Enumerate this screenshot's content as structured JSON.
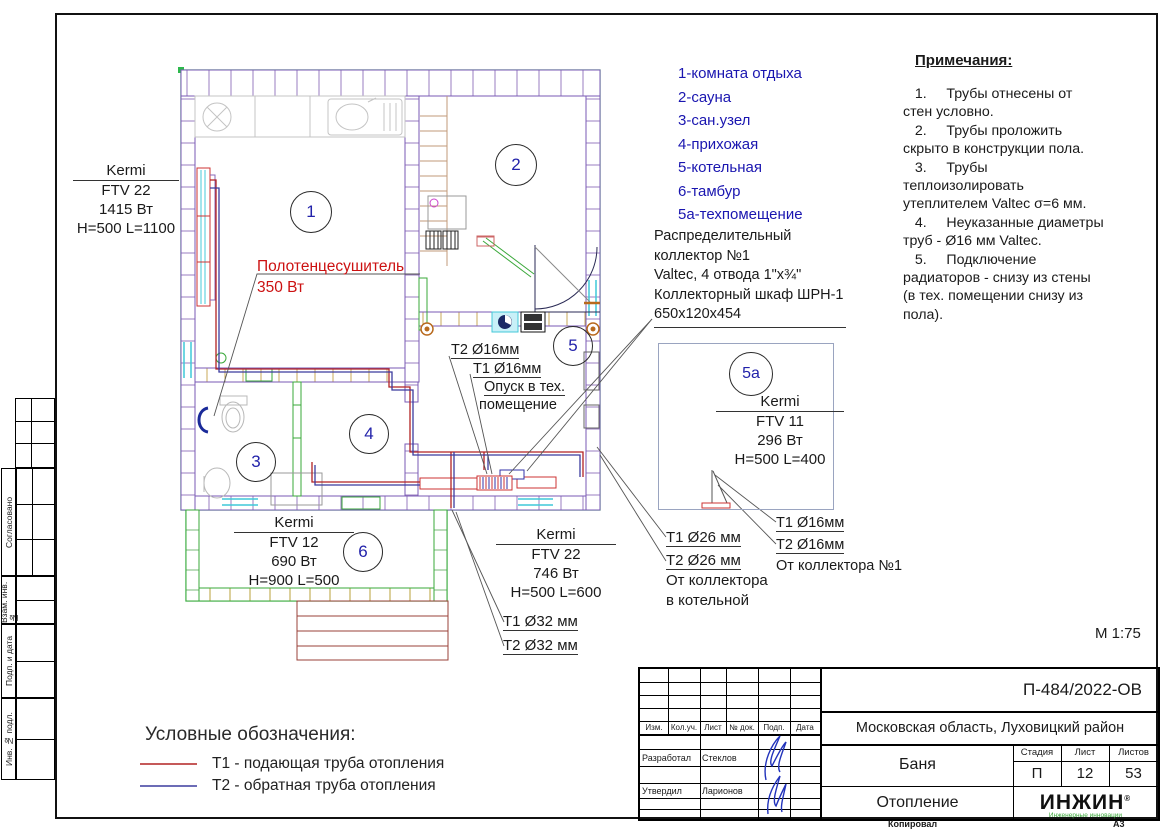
{
  "side_strip": {
    "labels": [
      "Согласовано",
      "Взам. инв. №",
      "Подп. и дата",
      "Инв. № подл."
    ]
  },
  "room_numbers": {
    "r1": "1",
    "r2": "2",
    "r3": "3",
    "r4": "4",
    "r5": "5",
    "r6": "6",
    "r5a": "5а"
  },
  "room_legend": {
    "items": [
      "1-комната отдыха",
      "2-сауна",
      "3-сан.узел",
      "4-прихожая",
      "5-котельная",
      "6-тамбур",
      "5а-техпомещение"
    ]
  },
  "collector_note": {
    "lines": [
      "Распределительный",
      "коллектор №1",
      "Valtec, 4 отвода 1\"х¾\"",
      "Коллекторный шкаф ШРН-1",
      "650х120х454"
    ]
  },
  "notes": {
    "title": "Примечания:",
    "items": [
      "   1.     Трубы отнесены от\nстен условно.",
      "   2.     Трубы проложить\nскрыто в конструкции пола.",
      "   3.     Трубы\nтеплоизолировать\nутеплителем Valtec σ=6 мм.",
      "   4.     Неуказанные диаметры\nтруб - Ø16 мм Valtec.",
      "   5.     Подключение\nрадиаторов - снизу из стены\n(в тех. помещении снизу из\nпола)."
    ]
  },
  "radiators": {
    "room1": {
      "brand": "Kermi",
      "model": "FTV 22",
      "power": "1415 Вт",
      "size": "H=500 L=1100"
    },
    "room6": {
      "brand": "Kermi",
      "model": "FTV 12",
      "power": "690 Вт",
      "size": "H=900 L=500"
    },
    "hall": {
      "brand": "Kermi",
      "model": "FTV 22",
      "power": "746 Вт",
      "size": "H=500 L=600"
    },
    "tech": {
      "brand": "Kermi",
      "model": "FTV 11",
      "power": "296 Вт",
      "size": "H=500 L=400"
    }
  },
  "towel_rail": {
    "name": "Полотенцесушитель",
    "power": "350 Вт"
  },
  "pipe_labels": {
    "drop_t2": "Т2 Ø16мм",
    "drop_t1": "Т1 Ø16мм",
    "drop_text1": "Опуск в тех.",
    "drop_text2": "помещение",
    "d32_t1": "Т1 Ø32 мм",
    "d32_t2": "Т2 Ø32 мм",
    "d26_t1": "Т1 Ø26 мм",
    "d26_t2": "Т2 Ø26 мм",
    "d26_from1": "От коллектора",
    "d26_from2": "в котельной",
    "d16_t1": "Т1 Ø16мм",
    "d16_t2": "Т2 Ø16мм",
    "d16_from": "От коллектора №1"
  },
  "scale_label": "М 1:75",
  "legend": {
    "title": "Условные обозначения:",
    "t1": "Т1 - подающая труба отопления",
    "t2": "Т2 - обратная труба отопления"
  },
  "title_block": {
    "doc_number": "П-484/2022-ОВ",
    "location": "Московская область, Луховицкий район",
    "object_name": "Баня",
    "drawing_name": "Отопление",
    "stage_label": "Стадия",
    "sheet_label": "Лист",
    "sheets_label": "Листов",
    "stage": "П",
    "sheet_no": "12",
    "sheets_total": "53",
    "cols": [
      "Изм.",
      "Кол.уч.",
      "Лист",
      "№ док.",
      "Подп.",
      "Дата"
    ],
    "row_developed": "Разработал",
    "name_developed": "Стеклов",
    "row_approved": "Утвердил",
    "name_approved": "Ларионов",
    "logo_text": "ИНЖИН",
    "logo_sub": "Инженерные инновации",
    "copied": "Копировал",
    "format": "А3"
  },
  "colors": {
    "t1_pipe": "#b22222",
    "t2_pipe": "#3b3b9e",
    "boundary_green": "#2db84d",
    "legend_blue": "#1a16b0",
    "warn_red": "#cc1111"
  }
}
